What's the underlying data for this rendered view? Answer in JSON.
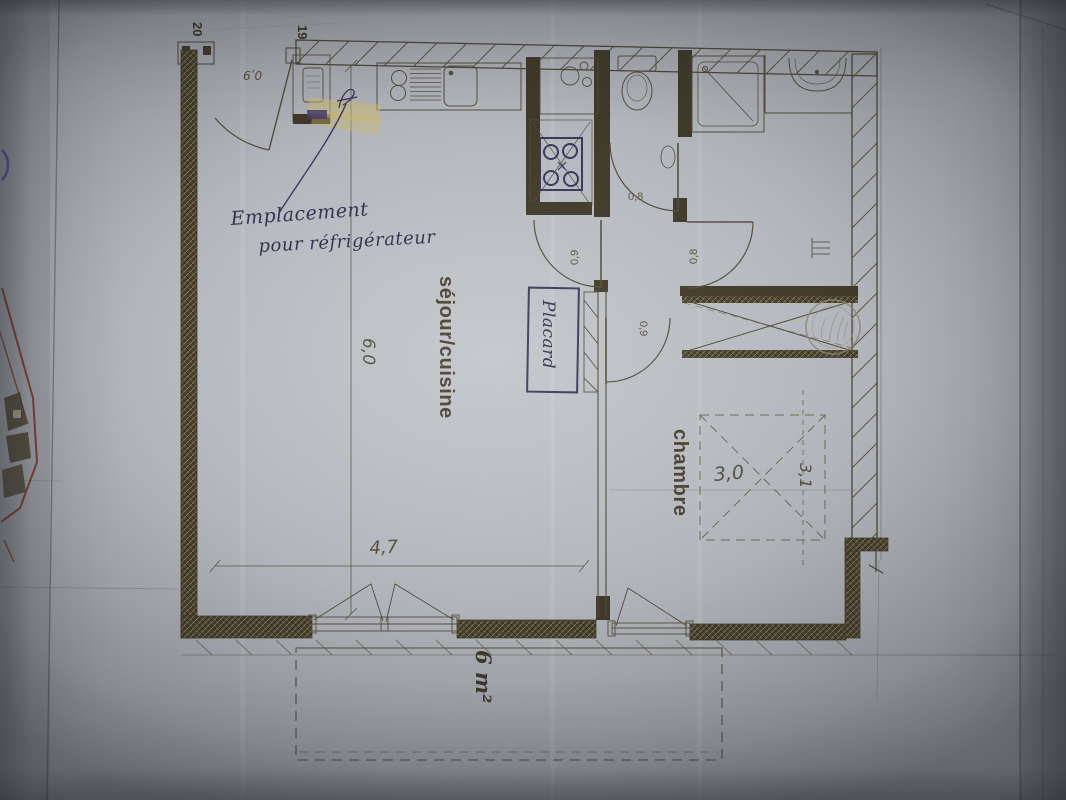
{
  "corridor": {
    "door_number_left": "20",
    "door_number_right": "19"
  },
  "rooms": {
    "living": "séjour/cuisine",
    "bedroom": "chambre"
  },
  "dims": {
    "living_depth": "6,0",
    "living_width": "4,7",
    "bedroom_width": "3,0",
    "bedroom_depth": "3,1",
    "balcony_area": "6 m²",
    "entrance_door": "0,9",
    "wc_door": "0,8",
    "living_door": "0,9",
    "bathroom_door": "0,8",
    "bedroom_door": "0,9"
  },
  "handwriting": {
    "fridge_line1": "Emplacement",
    "fridge_line2": "pour réfrigérateur",
    "closet": "Placard"
  },
  "colors": {
    "paper": "#b6bac0",
    "print_ink": "#544c3a",
    "wall_fill": "#3e3726",
    "highlighter": "#d0be6e",
    "hand_ink": "#33304e",
    "fragment_red": "#7a3426"
  }
}
